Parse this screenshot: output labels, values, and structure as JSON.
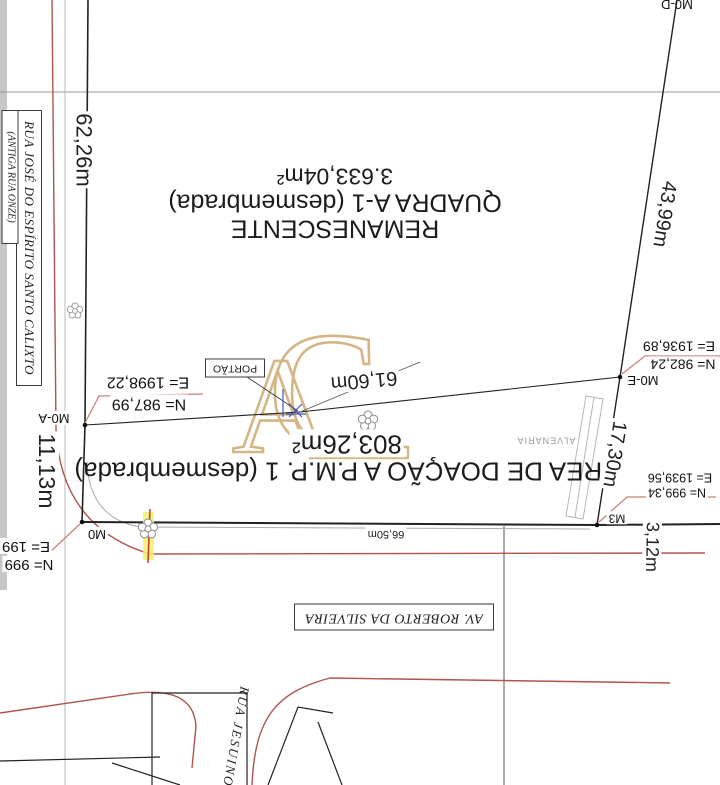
{
  "title": "survey-plat-drawing",
  "parcels": {
    "remanescente": {
      "line1": "REMANESCENTE",
      "line2": "QUADRA A-1 (desmembrada)",
      "area": "3.633,04m²"
    },
    "doacao": {
      "line1": "ÁREA DE DOAÇÃO A P.M.P. 1 (desmembrada)",
      "area": "803,26m²"
    }
  },
  "streets": {
    "left_street": "RUA JOSÉ DO ESPÍRITO SANTO CALIXTO",
    "left_street_alt": "(ANTIGA RUA ONZE)",
    "bottom_avenue": "AV. ROBERTO DA SILVEIRA",
    "diagonal_street": "RUA JESUINO"
  },
  "dimensions": {
    "west": "62,26m",
    "southwest": "11,13m",
    "northeast": "43,99m",
    "front": "61,60m",
    "south": "66,50m",
    "east_wall": "17,30m",
    "southeast": "3,12m"
  },
  "markers": {
    "m0a": {
      "label": "M0-A",
      "e": "E= 1998,22",
      "n": "N= 987,99"
    },
    "m0": {
      "label": "M0",
      "e": "E= 199",
      "n": "N= 999"
    },
    "m3": {
      "label": "M3",
      "e": "E= 1939,56",
      "n": "N= 999,34"
    },
    "m0e": {
      "label": "M0-E",
      "e": "E= 1936,89",
      "n": "N= 982,24"
    },
    "m0d": {
      "label": "M0-D"
    }
  },
  "annotations": {
    "gate": "PORTÃO",
    "wall": "ALVENARIA",
    "watermark": "AC"
  },
  "colors": {
    "street_red": "#b0544c",
    "leader_pink": "#c97d74",
    "watermark_gold": "#c9a466",
    "highlight_yellow": "#f3ee6d",
    "detail_blue": "#4a55b8",
    "line_black": "#222222",
    "line_gray": "#a8a8a8"
  }
}
